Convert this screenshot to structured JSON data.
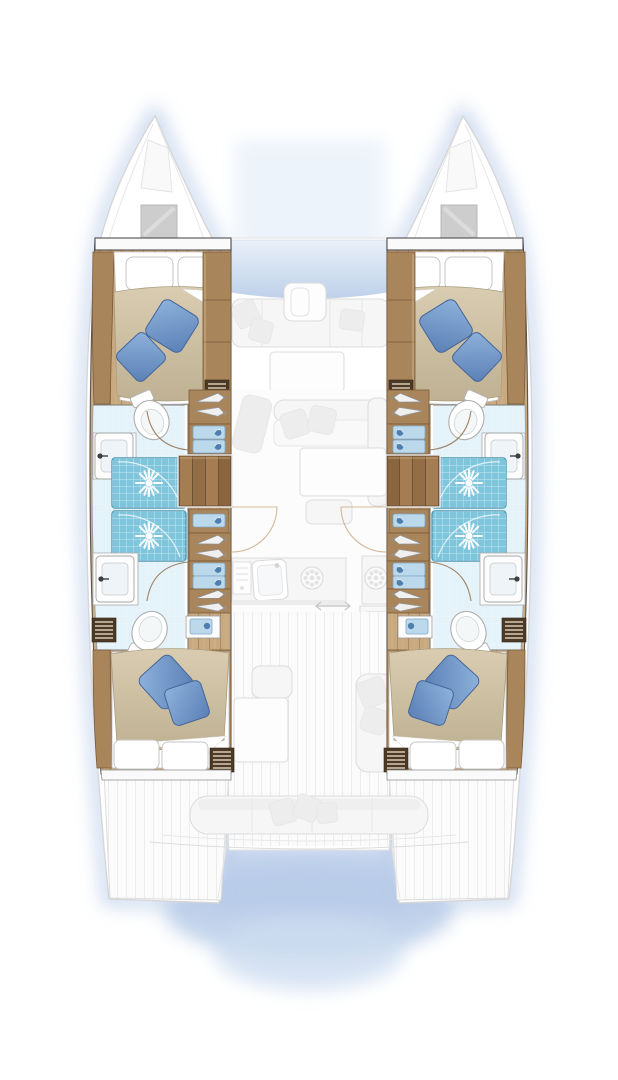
{
  "meta": {
    "diagram_type": "catamaran accommodation floor plan, overhead view",
    "visible_text": [],
    "style": "hull interiors rendered in full colour; main-deck salon, galley, cockpits and platforms ghosted in pale grey; soft blue drop shadow around hulls"
  },
  "colors": {
    "wood-floor": "#c9aa80",
    "wood-line": "#ad8a62",
    "wood-hi": "#d8bd94",
    "furniture": "#a8855b",
    "furniture-dark": "#7a5b39",
    "trim-dark": "#4c3a27",
    "slat": "#d8c9b4",
    "duvet1": "#d9ccb1",
    "duvet2": "#bfb192",
    "duvet-line": "#ab9d80",
    "pillow-blue1": "#8fb3dc",
    "pillow-blue2": "#5a7fb4",
    "pillow-blue-border": "#44659a",
    "shower": "#7fc5db",
    "shower-border": "#4e9ab4",
    "bath-floor": "#e4f2f9",
    "drawer-blue": "#bcd9ec",
    "drawer-blue-border": "#7fa8c6",
    "drawer-dot": "#4f7fae",
    "glass1": "#e9f0f8",
    "glass2": "#bed1ea",
    "ghost-line": "#dcdcdc",
    "ghost-line2": "#e7e7e7",
    "ghost-fill": "#f6f6f6",
    "ghost-cushion": "#ededed",
    "glow": "#b7cbe8",
    "outline": "#555555",
    "bulkhead": "#3f3f3f",
    "white": "#ffffff"
  },
  "vessel": {
    "type": "sailing catamaran",
    "layout_version": "4 double cabins / 4 heads / 4 shower stalls",
    "hulls": [
      "port",
      "starboard"
    ]
  },
  "rooms": {
    "port_forward_cabin": {
      "label": "Port forward cabin - double berth with two blue cushions"
    },
    "port_forward_head": {
      "label": "Port forward head - toilet, washbasin, shower"
    },
    "port_showers": {
      "label": "Port twin shower stalls"
    },
    "port_aft_head": {
      "label": "Port aft head - washbasin, toilet"
    },
    "port_aft_cabin": {
      "label": "Port aft cabin - double berth with two blue cushions"
    },
    "port_companionway": {
      "label": "Port companionway stairs with hanging lockers and drawers"
    },
    "stbd_forward_cabin": {
      "label": "Starboard forward cabin - double berth with two blue cushions"
    },
    "stbd_forward_head": {
      "label": "Starboard forward head - toilet, washbasin, shower"
    },
    "stbd_showers": {
      "label": "Starboard twin shower stalls"
    },
    "stbd_aft_head": {
      "label": "Starboard aft head - washbasin, toilet"
    },
    "stbd_aft_cabin": {
      "label": "Starboard aft cabin - double berth with two blue cushions"
    },
    "stbd_companionway": {
      "label": "Starboard companionway stairs with hanging lockers and drawers"
    },
    "forward_cockpit": {
      "label": "Forward cockpit lounge (ghosted)"
    },
    "salon": {
      "label": "Salon with sofa and table (ghosted)"
    },
    "galley": {
      "label": "Galley with sinks, stove and burners (ghosted)"
    },
    "aft_cockpit": {
      "label": "Aft cockpit with table and benches (ghosted)"
    },
    "transom_sofa": {
      "label": "Transom bench seat (ghosted)"
    },
    "swim_platform": {
      "label": "Swim platform between hull sterns"
    },
    "foredeck": {
      "label": "Foredeck with deck hatches"
    }
  },
  "fixtures": {
    "double_berths": 4,
    "toilets": 4,
    "washbasins": 4,
    "shower_stalls": 4,
    "companionway_stairs": 2,
    "deck_hatches": 2,
    "louvre_vents": 4,
    "hanging_lockers_per_hull": 3,
    "drawer_units_per_hull": 3,
    "galley_burners": 3,
    "galley_sinks": 2
  },
  "icons": [
    "toilet-icon",
    "washbasin-icon",
    "shower-sunburst-icon",
    "hanger-icon",
    "burner-icon",
    "stove-icon",
    "sink-icon",
    "stairs-icon",
    "sliding-door-arrow-icon",
    "deck-hatch-icon",
    "louvre-vent-icon",
    "door-swing-arc"
  ]
}
